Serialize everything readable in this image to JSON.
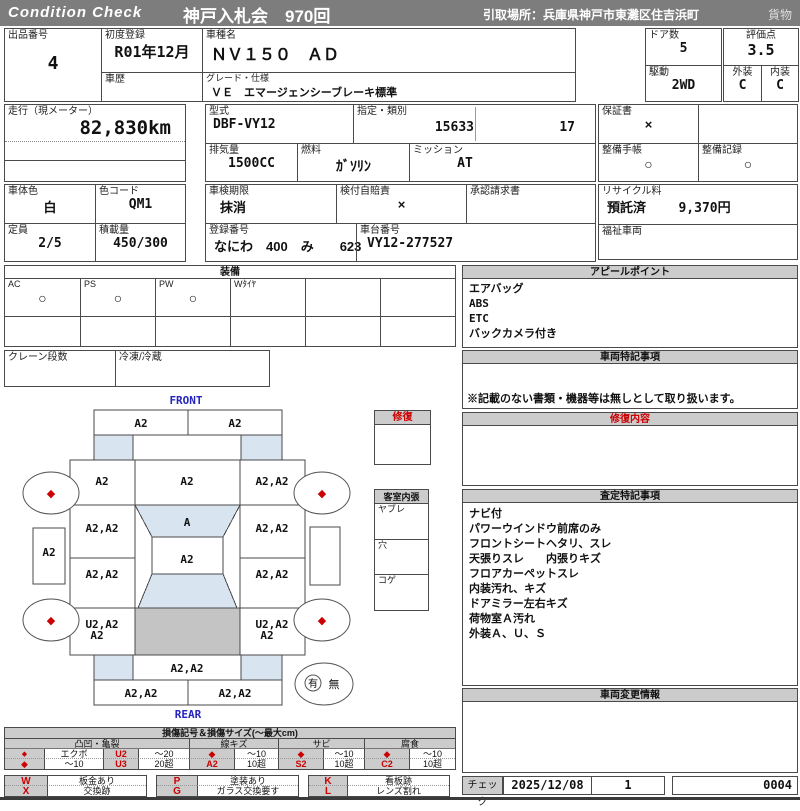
{
  "header": {
    "brand": "Condition  Check",
    "auction": "神戸入札会　970回",
    "pickup": "引取場所：兵庫県神戸市東灘区住吉浜町",
    "cargo": "貨物"
  },
  "info": {
    "exhibit_no_label": "出品番号",
    "exhibit_no": "4",
    "first_reg_label": "初度登録",
    "first_reg": "R01年12月",
    "history_label": "車歴",
    "history": "",
    "model_name_label": "車種名",
    "model_name": "ＮＶ１５０　ＡＤ",
    "grade_label": "グレード・仕様",
    "grade": "ＶＥ　エマージェンシーブレーキ標準",
    "doors_label": "ドア数",
    "doors": "5",
    "score_label": "評価点",
    "score": "3.5",
    "drive_label": "駆動",
    "drive": "2WD",
    "exterior_label": "外装",
    "exterior": "C",
    "interior_label": "内装",
    "interior": "C",
    "mileage_label": "走行（現メーター）",
    "mileage": "82,830km",
    "model_code_label": "型式",
    "model_code": "DBF-VY12",
    "class_label": "指定・類別",
    "class_no": "15633",
    "class_no2": "17",
    "displacement_label": "排気量",
    "displacement": "1500CC",
    "fuel_label": "燃料",
    "fuel": "ｶﾞｿﾘﾝ",
    "mission_label": "ミッション",
    "mission": "AT",
    "warranty_label": "保証書",
    "warranty": "×",
    "maint_book_label": "整備手帳",
    "maint_book": "○",
    "maint_record_label": "整備記録",
    "maint_record": "○",
    "body_color_label": "車体色",
    "body_color": "白",
    "color_code_label": "色コード",
    "color_code": "QM1",
    "inspection_label": "車検期限",
    "inspection": "抹消",
    "insurance_label": "検付自賠責",
    "insurance": "×",
    "approval_label": "承認請求書",
    "approval": "",
    "recycle_label": "リサイクル料",
    "recycle_status": "預託済",
    "recycle_fee": "9,370円",
    "capacity_label": "定員",
    "capacity": "2/5",
    "load_label": "積載量",
    "load": "450/300",
    "reg_no_label": "登録番号",
    "reg_no": "なにわ　400　み　　623",
    "chassis_label": "車台番号",
    "chassis_no": "VY12-277527",
    "welfare_label": "福祉車両",
    "welfare": ""
  },
  "equipment": {
    "title": "装備",
    "items": [
      {
        "label": "AC",
        "value": "○"
      },
      {
        "label": "PS",
        "value": "○"
      },
      {
        "label": "PW",
        "value": "○"
      },
      {
        "label": "Wﾀｲﾔ",
        "value": ""
      },
      {
        "label": "",
        "value": ""
      },
      {
        "label": "",
        "value": ""
      }
    ],
    "crane_label": "クレーン段数",
    "crane": "",
    "reefer_label": "冷凍/冷蔵",
    "reefer": ""
  },
  "panels": {
    "appeal_title": "アピールポイント",
    "appeal_lines": [
      "エアバッグ",
      "ABS",
      "ETC",
      "バックカメラ付き"
    ],
    "vehicle_notes_title": "車両特記事項",
    "vehicle_notes_footer": "※記載のない書類・機器等は無しとして取り扱います。",
    "repair_title": "修復内容",
    "assessment_title": "査定特記事項",
    "assessment_lines": [
      "ナビ付",
      "パワーウインドウ前席のみ",
      "フロントシートヘタリ、スレ",
      "天張りスレ　　内張りキズ",
      "フロアカーペットスレ",
      "内装汚れ、キズ",
      "ドアミラー左右キズ",
      "荷物室Ａ汚れ",
      "外装Ａ、Ｕ、Ｓ"
    ],
    "change_title": "車両変更情報",
    "check_label": "チェック",
    "check_date": "2025/12/08",
    "check_no": "1",
    "sheet_no": "0004"
  },
  "repair_box": {
    "title": "修復"
  },
  "cabin_box": {
    "title": "客室内張",
    "items": [
      "ヤブレ",
      "穴",
      "コゲ"
    ]
  },
  "diagram": {
    "front_label": "FRONT",
    "rear_label": "REAR",
    "marks": {
      "front_bumper_l": "A2",
      "front_bumper_r": "A2",
      "fender_l": "A2",
      "hood": "A2",
      "fender_r": "A2,A2",
      "door_fl": "A2,A2",
      "windshield": "A",
      "door_fr": "A2,A2",
      "sill_l": "A2",
      "sill_r": "",
      "roof": "A2",
      "door_rl": "A2,A2",
      "door_rr": "A2,A2",
      "quarter_l1": "U2,A2",
      "quarter_l2": "A2",
      "quarter_r1": "U2,A2",
      "quarter_r2": "A2",
      "rear_panel": "A2,A2",
      "rear_bumper_l": "A2,A2",
      "rear_bumper_r": "A2,A2",
      "wheel_mark": "◆"
    },
    "spare": {
      "yes": "有",
      "no": "無"
    }
  },
  "legend": {
    "title": "損傷記号＆損傷サイズ(〜最大cm)",
    "groups": [
      {
        "name": "凸凹・亀裂",
        "rows": [
          [
            "◆",
            "エクボ",
            "U2",
            "〜20"
          ],
          [
            "◆",
            "〜10",
            "U3",
            "20超"
          ]
        ]
      },
      {
        "name": "線キズ",
        "rows": [
          [
            "◆",
            "〜10"
          ],
          [
            "A2",
            "10超"
          ]
        ]
      },
      {
        "name": "サビ",
        "rows": [
          [
            "◆",
            "〜10"
          ],
          [
            "S2",
            "10超"
          ]
        ]
      },
      {
        "name": "腐食",
        "rows": [
          [
            "◆",
            "〜10"
          ],
          [
            "C2",
            "10超"
          ]
        ]
      }
    ],
    "codes": [
      [
        "W",
        "板金あり",
        "P",
        "塗装あり",
        "K",
        "看板跡"
      ],
      [
        "X",
        "交換跡",
        "G",
        "ガラス交換要す",
        "L",
        "レンズ割れ"
      ]
    ]
  },
  "colors": {
    "accent_red": "#cc0000",
    "header_gray": "#7d7d7d",
    "section_gray": "#cccccc",
    "glass_blue": "#d9e4f1",
    "cargo_gray": "#c4c4c4",
    "label_blue": "#2424c0"
  }
}
